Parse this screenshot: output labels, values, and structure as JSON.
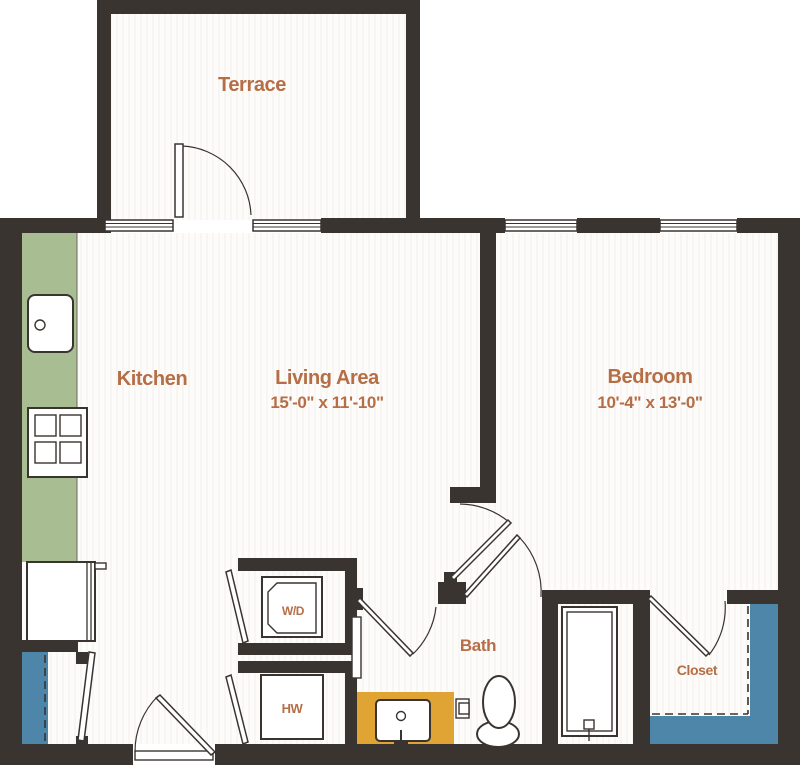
{
  "rooms": {
    "terrace": {
      "label": "Terrace"
    },
    "kitchen": {
      "label": "Kitchen"
    },
    "living": {
      "label": "Living Area",
      "dimensions": "15'-0\" x 11'-10\""
    },
    "bedroom": {
      "label": "Bedroom",
      "dimensions": "10'-4\" x 13'-0\""
    },
    "bath": {
      "label": "Bath"
    },
    "closet": {
      "label": "Closet"
    }
  },
  "fixtures": {
    "washer_dryer": {
      "label": "W/D"
    },
    "water_heater": {
      "label": "HW"
    }
  },
  "colors": {
    "wall": "#3a3430",
    "label": "#b56e46",
    "green": "#a9bd92",
    "teal": "#4d86a8",
    "gold": "#dfa434",
    "floor": "#fdfcfa",
    "floorline": "#f2efeb"
  }
}
